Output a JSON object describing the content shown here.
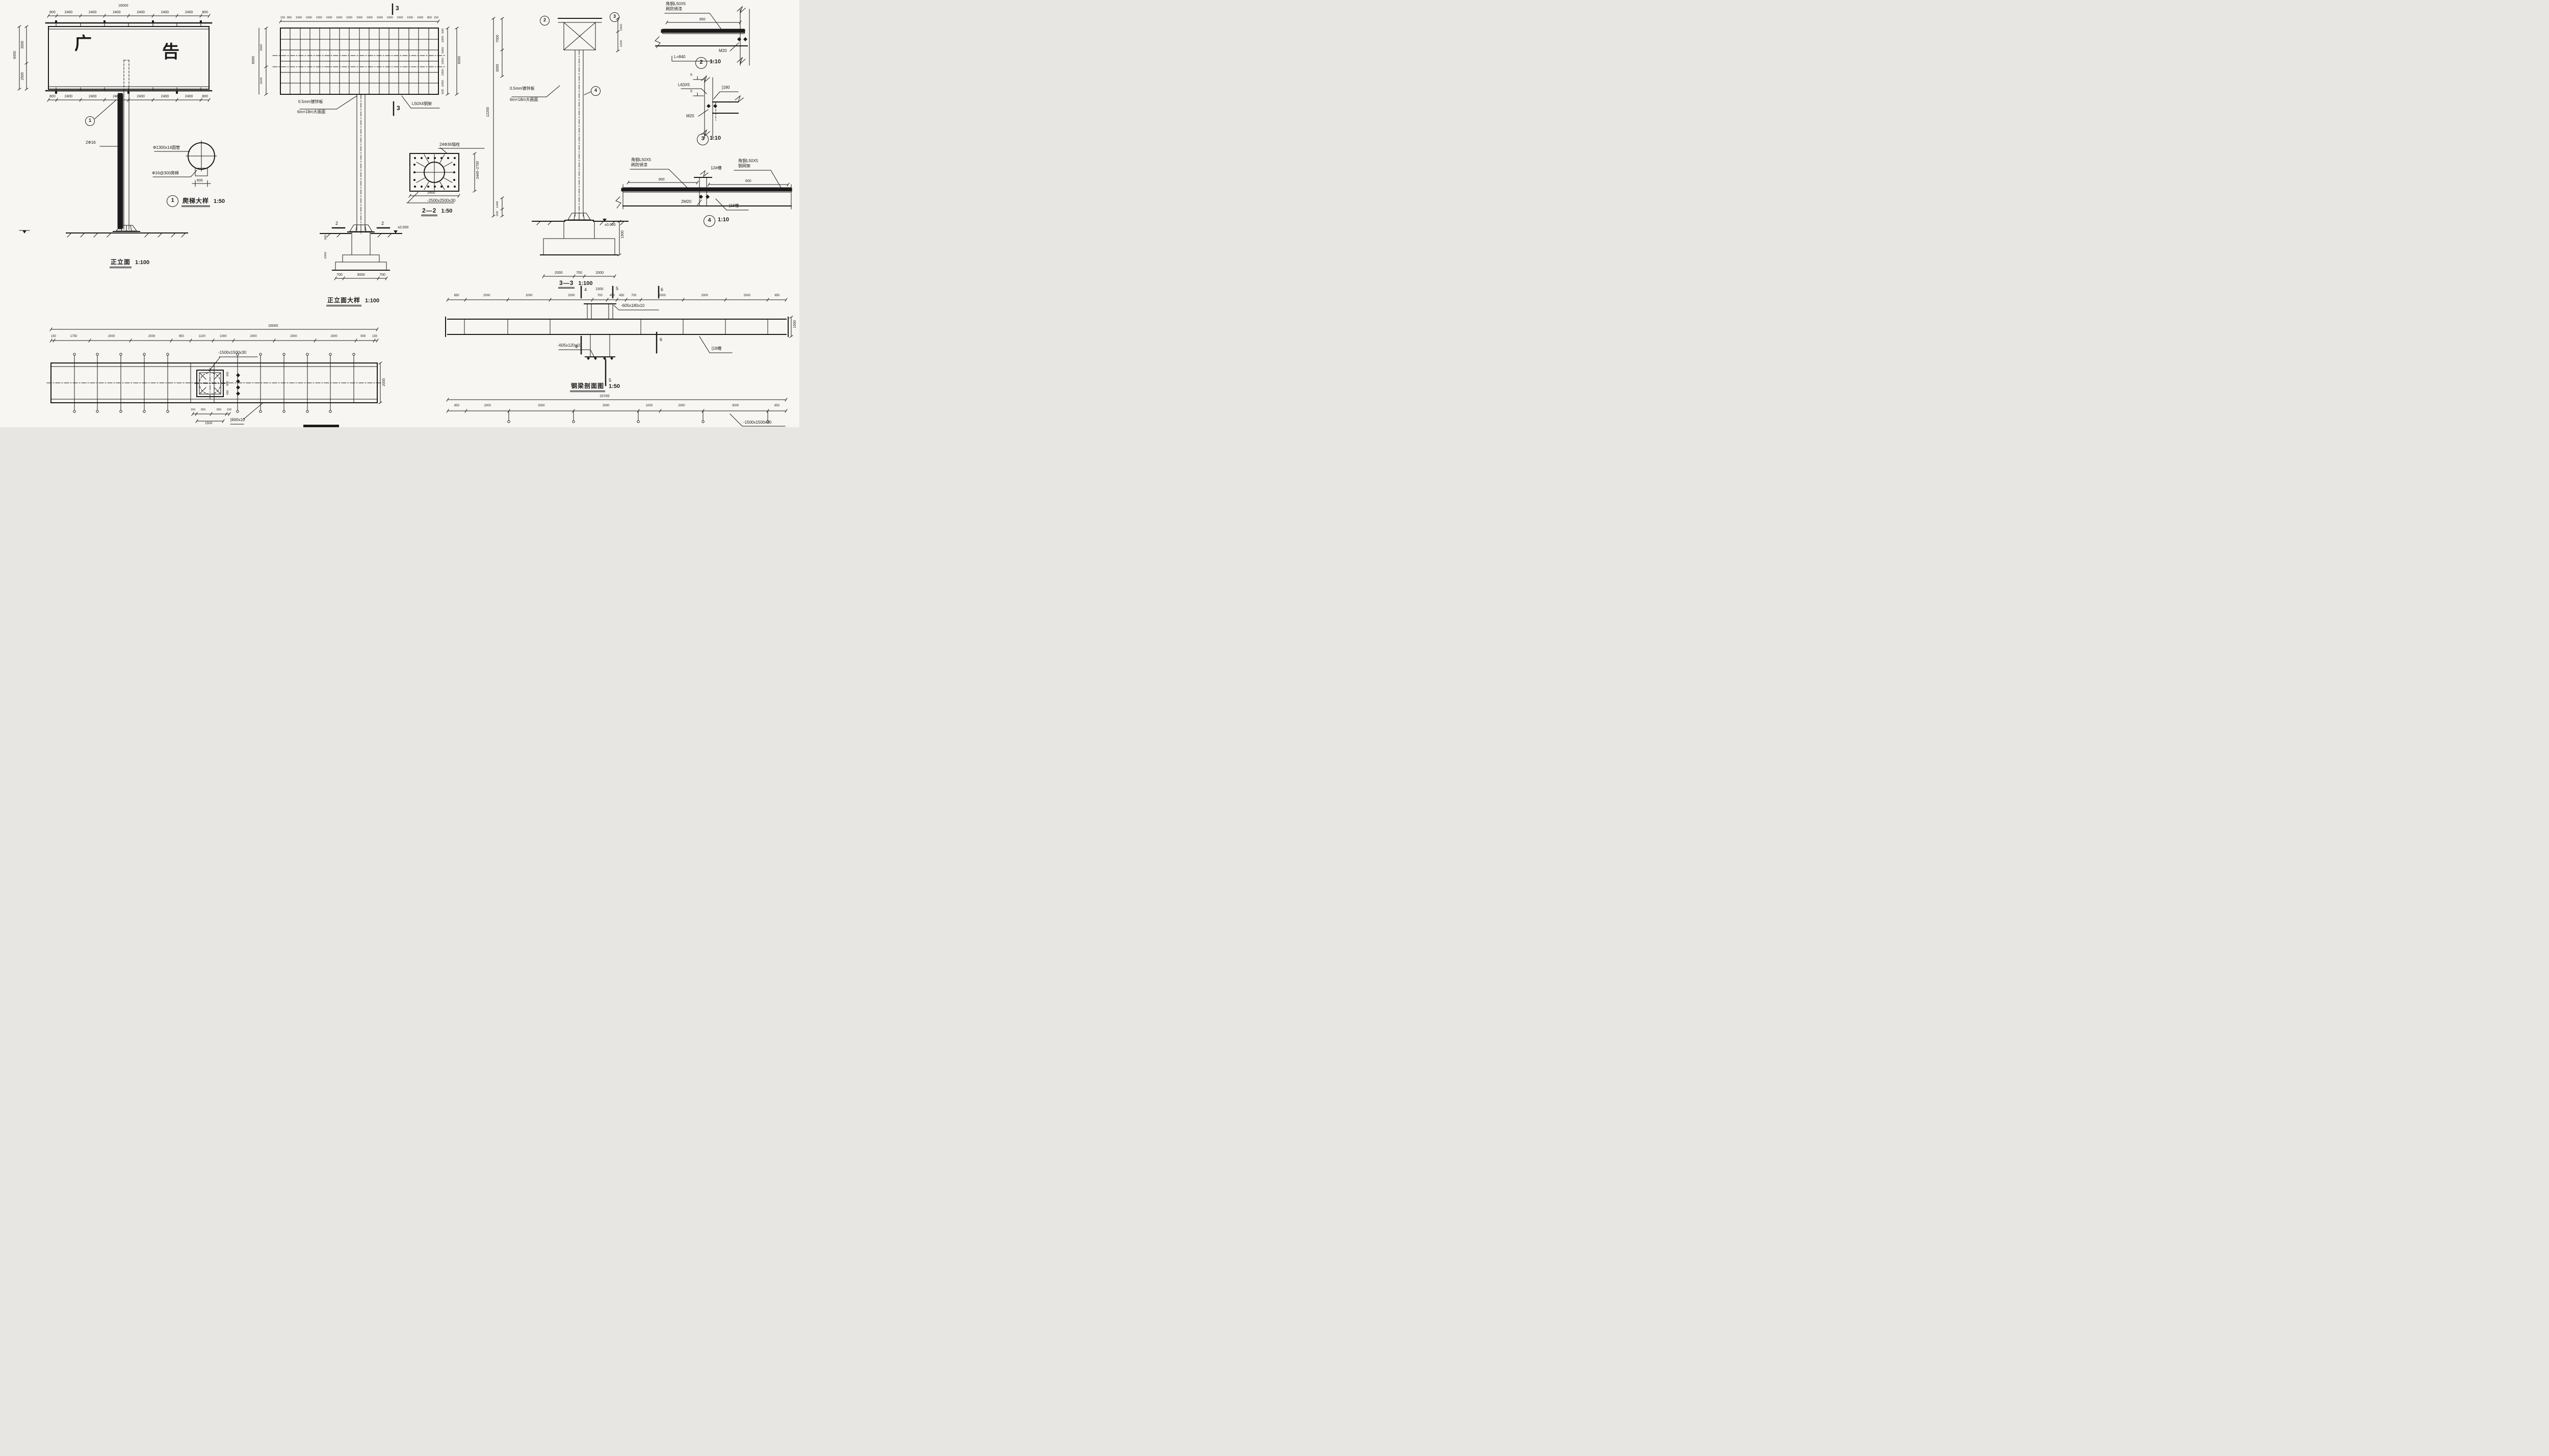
{
  "front": {
    "title": "正立面",
    "scale": "1:100",
    "total_top": "16000",
    "dims_top": [
      "800",
      "2400",
      "2400",
      "2400",
      "2400",
      "2400",
      "2400",
      "800"
    ],
    "dims_bottom": [
      "800",
      "2400",
      "2400",
      "2400",
      "2400",
      "2400",
      "2400",
      "800"
    ],
    "dims_left": [
      "3500",
      "2500"
    ],
    "total_left": "6000",
    "board_char1": "广",
    "board_char2": "告",
    "callout_num": "1",
    "rebar_label": "2Φ16"
  },
  "ladder": {
    "callout_num": "1",
    "title": "爬梯大样",
    "scale": "1:50",
    "pipe_label": "Φ1300x14圆管",
    "rung_label": "Φ16@300爬梯",
    "width_dim": "600"
  },
  "front_large": {
    "title": "正立面大样",
    "scale": "1:100",
    "dims_top": [
      "150",
      "850",
      "1000",
      "1000",
      "1000",
      "1000",
      "1000",
      "1000",
      "1000",
      "1000",
      "1000",
      "1000",
      "1000",
      "1000",
      "1000",
      "850",
      "150"
    ],
    "dims_right": [
      "500",
      "1000",
      "1000",
      "1000",
      "1000",
      "1000",
      "500"
    ],
    "total_right": "6000",
    "dims_left": [
      "3500",
      "2500"
    ],
    "total_left": "6000",
    "panel_label_1": "0.5mm镀锌板",
    "panel_label_2": "6m×18m大画面",
    "angle_label": "L50X4钢架",
    "section_marker": "3",
    "cut_marker": "2",
    "level_label": "±0.000",
    "found_dims": [
      "700",
      "3000",
      "700"
    ],
    "depth_dims": [
      "500",
      "2000"
    ]
  },
  "flange": {
    "title": "2—2",
    "scale": "1:50",
    "bolt_label": "24Φ36锚栓",
    "anchor_dim": "2400",
    "plate_label": "-2500x2500x30",
    "side_dim": "2440~2700"
  },
  "section33": {
    "title": "3—3",
    "scale": "1:100",
    "callout_top_left": "2",
    "callout_top_right": "3",
    "callout_mid": "4",
    "dims_left_inner": [
      "7000",
      "3000"
    ],
    "dim_left_outer": "12200",
    "dims_right": [
      "1500",
      "1200"
    ],
    "dims_lower": [
      "1500",
      "500"
    ],
    "panel_label_1": "0.5mm镀锌板",
    "panel_label_2": "6m×18m大画面",
    "level_label": "±0.000",
    "found_dims": [
      "2000",
      "700",
      "2000"
    ],
    "depth_dim": "1500"
  },
  "detail2": {
    "num": "2",
    "scale": "1:10",
    "label_1": "角钢L50X5",
    "label_2": "刷防锈漆",
    "dim": "850",
    "bolt_label": "M20",
    "length_label": "L=840"
  },
  "detail3": {
    "num": "3",
    "scale": "1:10",
    "weld_1": "5",
    "weld_2": "5",
    "angle_label": "L63X5",
    "channel_label": "[180",
    "bolt_label": "M20"
  },
  "detail4": {
    "num": "4",
    "scale": "1:10",
    "left_label_1": "角钢L50X5",
    "left_label_2": "刷防锈漆",
    "right_label_1": "角钢L50X5",
    "right_label_2": "钢网架",
    "splice_label": "12#槽",
    "dim_left": "800",
    "dim_right": "600",
    "bolt_label": "2M20",
    "channel_label": "[18槽"
  },
  "beam": {
    "title": "钢梁剖面图",
    "scale": "1:50",
    "dims_top": [
      "850",
      "2000",
      "2000",
      "2000",
      "700",
      "450",
      "450",
      "700",
      "2000",
      "2000",
      "2000",
      "850"
    ],
    "center_dim": "1500",
    "marker_4": "4",
    "marker_5": "5",
    "marker_6": "6",
    "plate_label_1": "-605x180x10",
    "plate_label_2": "-605x120x10",
    "channel_label": "[18槽",
    "end_dim": "1500"
  },
  "plan": {
    "total": "16000",
    "dims_top": [
      "150",
      "1750",
      "2000",
      "2000",
      "950",
      "1100",
      "1000",
      "2000",
      "2000",
      "2000",
      "900",
      "150"
    ],
    "plate_label": "-1500x1500x30",
    "under_dims": [
      "150",
      "650",
      "650",
      "150"
    ],
    "under_total": "1500",
    "side_dims": [
      "450",
      "600",
      "450"
    ],
    "channel_label": "[600x10",
    "right_dim": "2000"
  },
  "chain2": {
    "total": "15700",
    "dims": [
      "850",
      "2000",
      "3000",
      "3000",
      "1000",
      "2000",
      "3000",
      "850"
    ],
    "plate_label": "-1500x1500x30"
  }
}
